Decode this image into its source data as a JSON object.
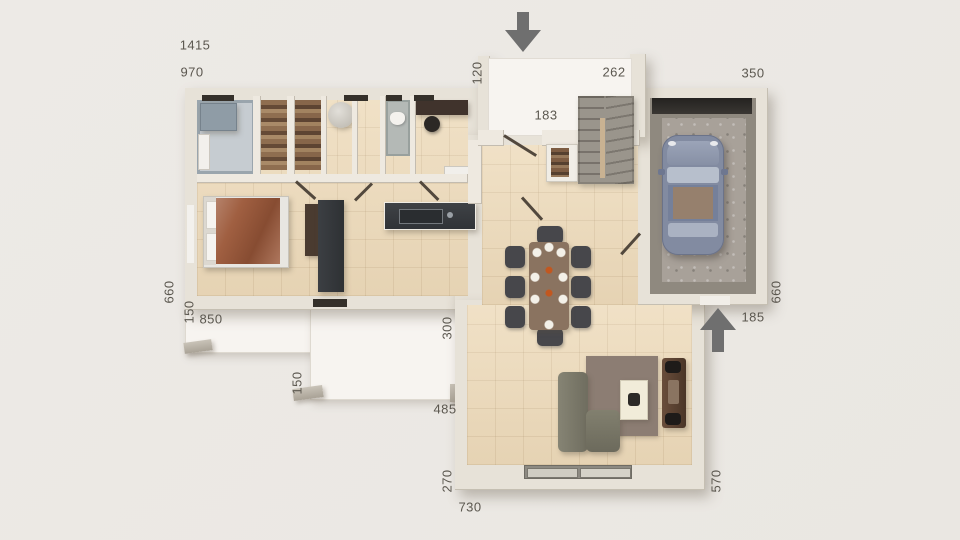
{
  "page": {
    "type": "3d-floor-plan-top-view",
    "background": "#ebe8e4"
  },
  "labels": {
    "w1415": "1415",
    "w970": "970",
    "w120": "120",
    "w262": "262",
    "w350": "350",
    "w183": "183",
    "w660l": "660",
    "w150a": "150",
    "w850": "850",
    "w150b": "150",
    "w300": "300",
    "w485": "485",
    "w270": "270",
    "w730": "730",
    "w570": "570",
    "w185": "185",
    "w660r": "660"
  },
  "icons": {
    "entry_arrow": "arrow-down",
    "garage_side_arrow": "arrow-up"
  },
  "colors": {
    "label_text": "#5b574f",
    "arrow": "#6f6f6f",
    "wall": "#e7e2d8",
    "tile_floor": "#eedcbd",
    "terrace_floor": "#f7f4f0",
    "garage_concrete": "#a39c93",
    "car_body": "#828ba1",
    "bed_duvet": "#a05f41",
    "kitchen_dark": "#35383c",
    "dining_table": "#8a7360",
    "sofa": "#7b796b",
    "rug": "#8c7d73",
    "tv_console": "#5a4233"
  }
}
